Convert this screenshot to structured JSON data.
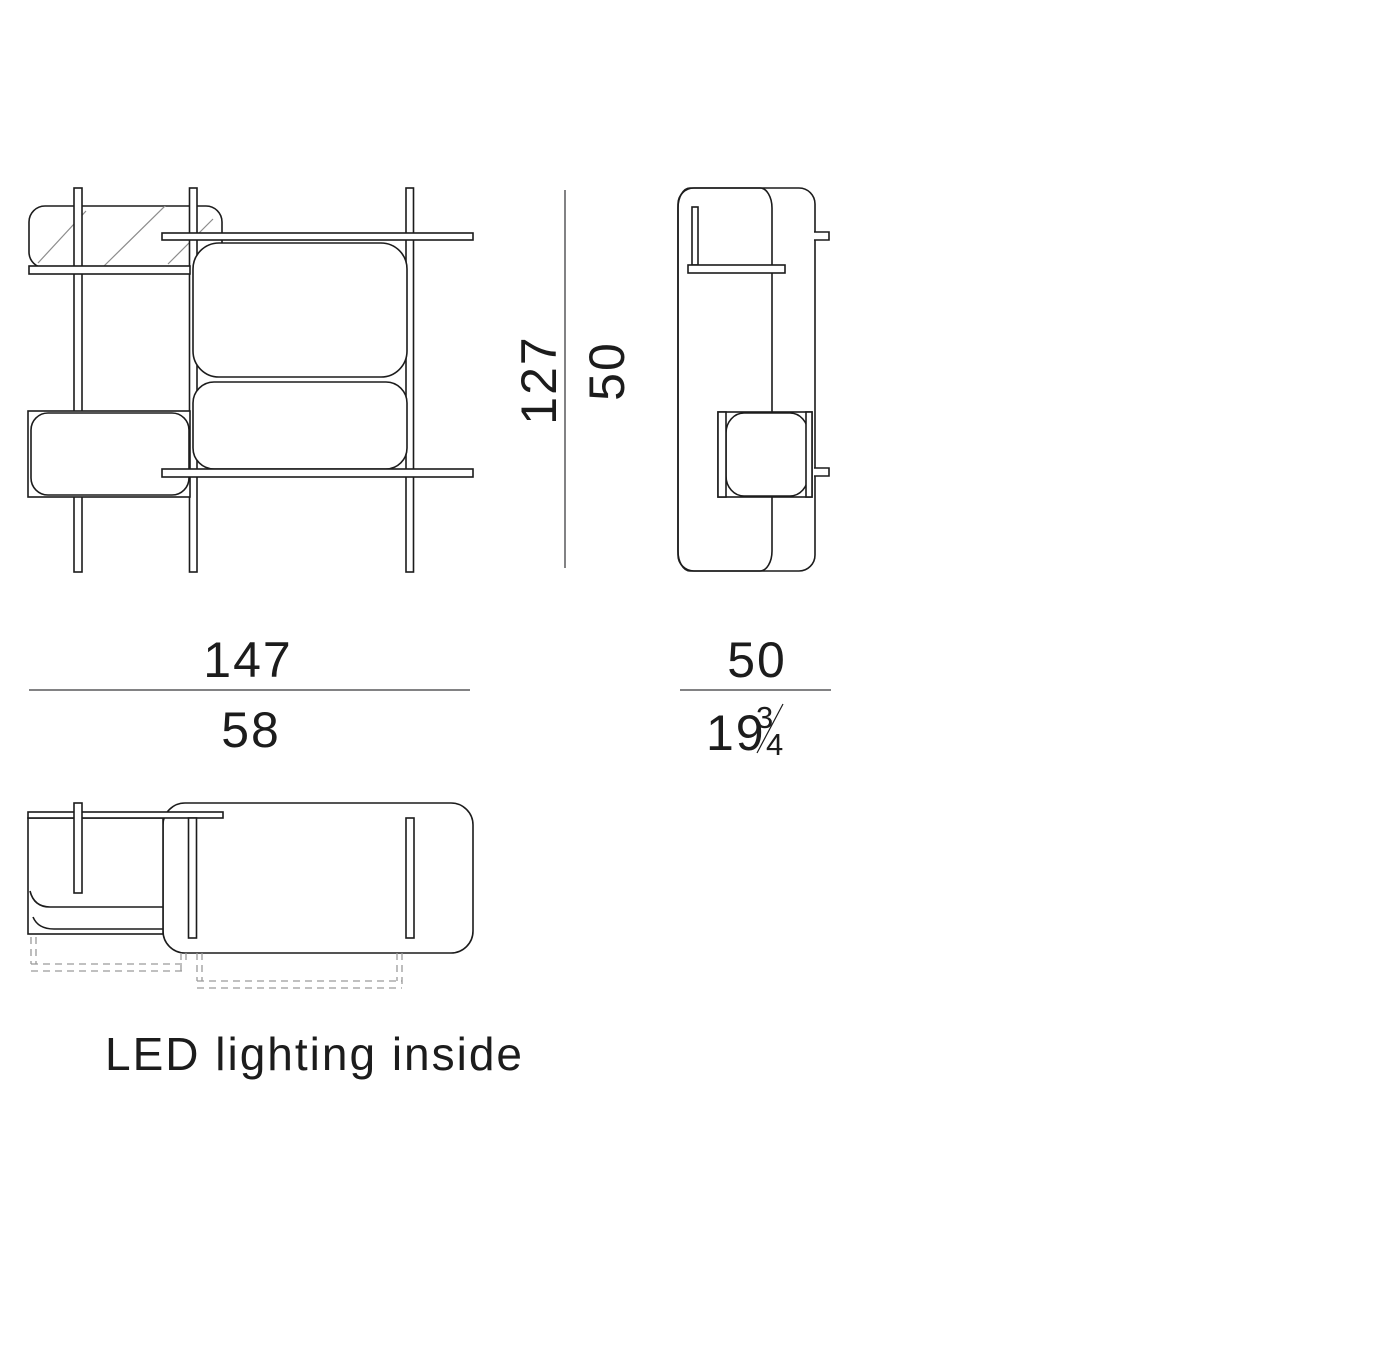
{
  "drawing": {
    "note": "LED lighting inside",
    "dimensions": {
      "width_cm": "147",
      "width_in": "58",
      "height_cm": "127",
      "height_in": "50",
      "depth_cm": "50",
      "depth_in_whole": "19",
      "depth_in_frac_num": "3",
      "depth_in_frac_den": "4"
    }
  },
  "colors": {
    "line": "#1c1c1c",
    "dimension_line": "#59595b",
    "text": "#1c1c1c",
    "hatch": "#8c8c8c",
    "dashed": "#9a9a9a",
    "background": "#ffffff"
  }
}
